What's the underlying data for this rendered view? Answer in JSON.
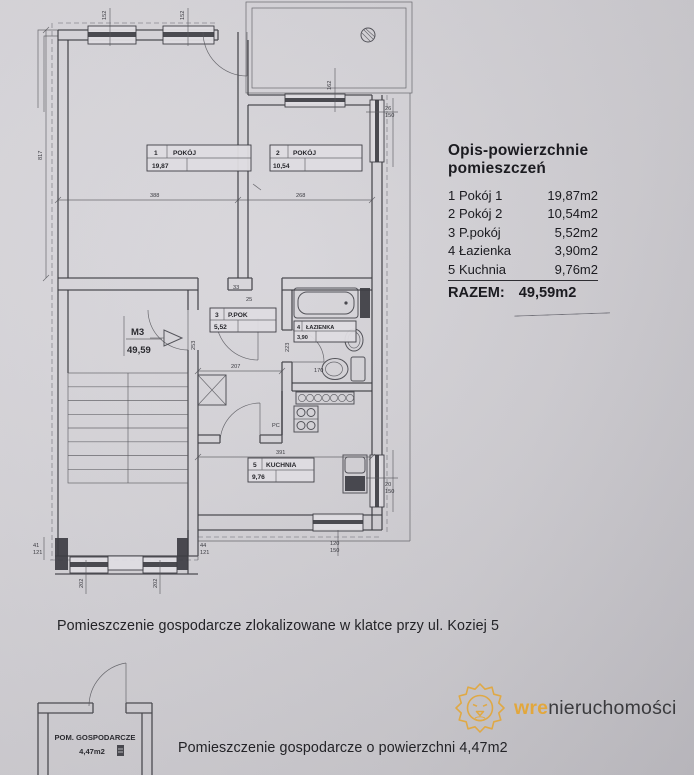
{
  "page": {
    "paper_light": "#dad8dd",
    "paper_dark": "#c3c1c7",
    "ink": "#3e3e44",
    "text_ink": "#1b1b20"
  },
  "legend": {
    "title": "Opis-powierzchnie pomieszczeń",
    "items": [
      {
        "no": "1",
        "name": "Pokój 1",
        "area": "19,87m2"
      },
      {
        "no": "2",
        "name": "Pokój 2",
        "area": "10,54m2"
      },
      {
        "no": "3",
        "name": "P.pokój",
        "area": "5,52m2"
      },
      {
        "no": "4",
        "name": "Łazienka",
        "area": "3,90m2"
      },
      {
        "no": "5",
        "name": "Kuchnia",
        "area": "9,76m2"
      }
    ],
    "total_label": "RAZEM:",
    "total_value": "49,59m2"
  },
  "plan": {
    "unit": {
      "code": "M3",
      "area": "49,59"
    },
    "rooms": [
      {
        "no": "1",
        "name": "POKÓJ",
        "area": "19,87"
      },
      {
        "no": "2",
        "name": "POKÓJ",
        "area": "10,54"
      },
      {
        "no": "3",
        "name": "P.POK",
        "area": "5,52"
      },
      {
        "no": "4",
        "name": "ŁAZIENKA",
        "area": "3,90"
      },
      {
        "no": "5",
        "name": "KUCHNIA",
        "area": "9,76"
      }
    ],
    "dims": {
      "left_height": "817",
      "room1_width": "388",
      "room2_width": "268",
      "top_window_1": "152",
      "top_window_2": "152",
      "balcony_window": "162",
      "hall_width": "207",
      "hall_pier": "33",
      "hall_pier2": "25",
      "hall_depth": "253",
      "bath_depth": "223",
      "toilet_width": "170",
      "kitchen_width": "391",
      "stove_label": "PC",
      "right_window_top": [
        "26",
        "150"
      ],
      "right_window_bottom": [
        "20",
        "150"
      ],
      "bottom_window": [
        "120",
        "150"
      ],
      "bottom_left_marker": [
        "41",
        "121"
      ],
      "bottom_right_marker": [
        "44",
        "121"
      ],
      "bottom_width_1": "202",
      "bottom_width_2": "202"
    }
  },
  "storage_plan": {
    "label": "POM. GOSPODARCZE",
    "area": "4,47m2"
  },
  "captions": {
    "location": "Pomieszczenie gospodarcze zlokalizowane w klatce przy ul. Koziej 5",
    "area": "Pomieszczenie gospodarcze o powierzchni 4,47m2"
  },
  "logo": {
    "brand_accent": "wre",
    "brand_rest": "nieruchomości",
    "gold": "#e2a73c",
    "dark": "#3b3b3e"
  }
}
